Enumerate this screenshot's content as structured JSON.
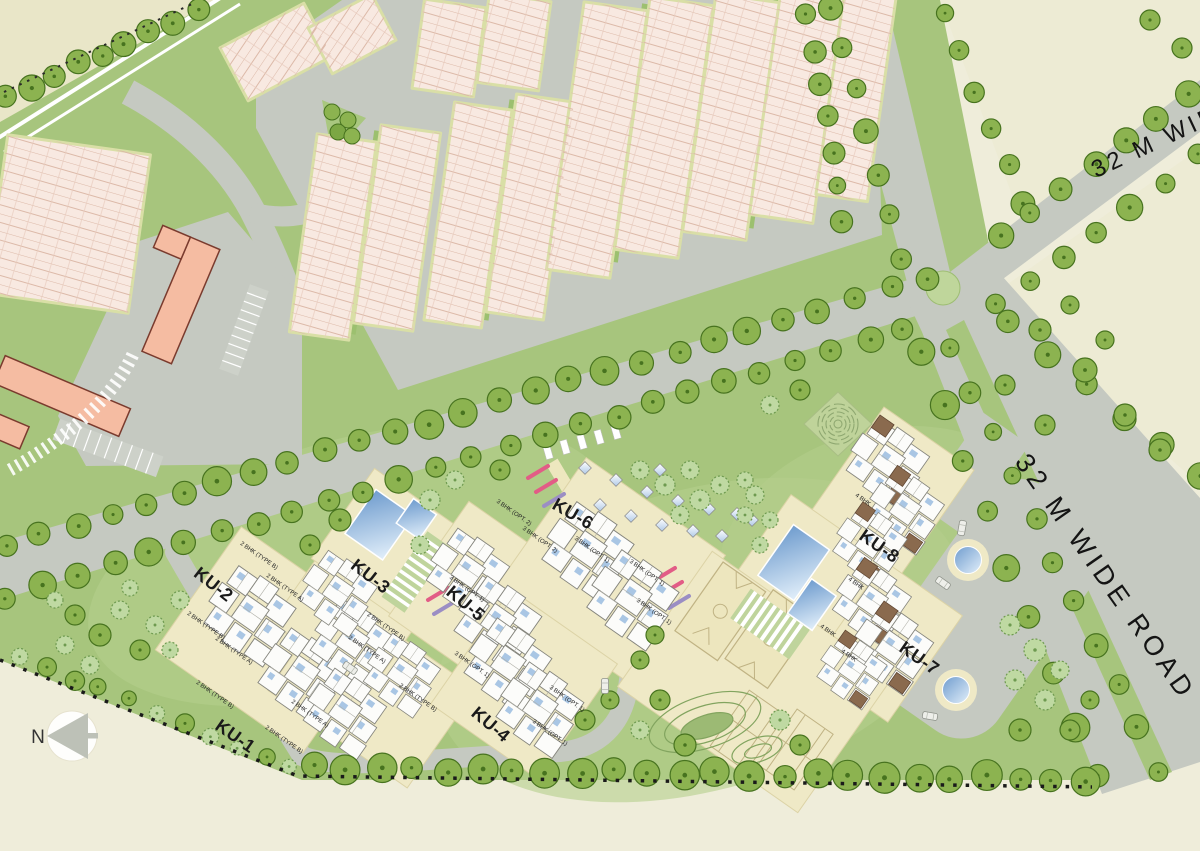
{
  "compass": {
    "north_label": "N"
  },
  "roads": {
    "wide_road_label": "32 M WIDE ROAD"
  },
  "clusters": [
    {
      "label": "KU-1"
    },
    {
      "label": "KU-2"
    },
    {
      "label": "KU-3"
    },
    {
      "label": "KU-4"
    },
    {
      "label": "KU-5"
    },
    {
      "label": "KU-6"
    },
    {
      "label": "KU-7"
    },
    {
      "label": "KU-8"
    }
  ],
  "unit_types": {
    "type_a_2bhk": "2 BHK (TYPE A)",
    "type_b_2bhk": "2 BHK (TYPE B)",
    "opt1_3bhk": "3 BHK (OPT. 1)",
    "opt2_3bhk": "3 BHK (OPT. 2)",
    "bhk4": "4 BHK"
  },
  "colors": {
    "background_beige": "#EFEDDA",
    "field_beige": "#E9E6C8",
    "site_green": "#A7C57D",
    "light_lawn": "#B6CF8E",
    "road_gray": "#C5C9C1",
    "tree_green": "#8CB350",
    "tree_outline": "#47731F",
    "rowhouse_pink": "#F8E9E1",
    "rowhouse_line": "#DCB9A8",
    "community_salmon": "#F5BCA2",
    "pool_blue": "#6F9CCE",
    "amenity_cream": "#EFE9C6",
    "accent_pink_bar": "#E25C86",
    "accent_purple_bar": "#9B8EC4",
    "label_color": "#1a1a1a"
  }
}
